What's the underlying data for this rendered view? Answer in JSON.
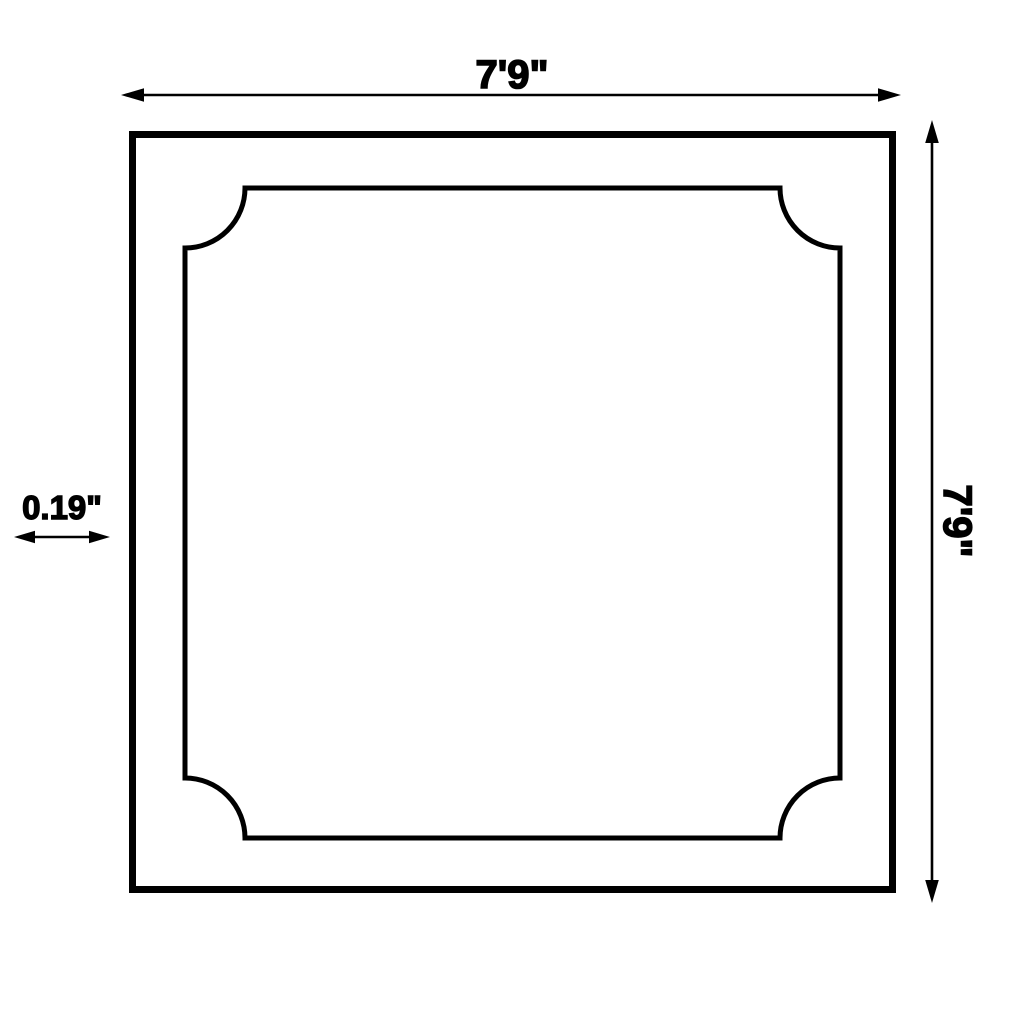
{
  "canvas": {
    "background_color": "#ffffff",
    "line_color": "#000000",
    "description": "Dimension drawing of a square panel with scalloped inner frame"
  },
  "dimension_labels": {
    "top_width": "7'9\"",
    "right_height": "7'9\"",
    "left_thickness": "0.19\""
  }
}
